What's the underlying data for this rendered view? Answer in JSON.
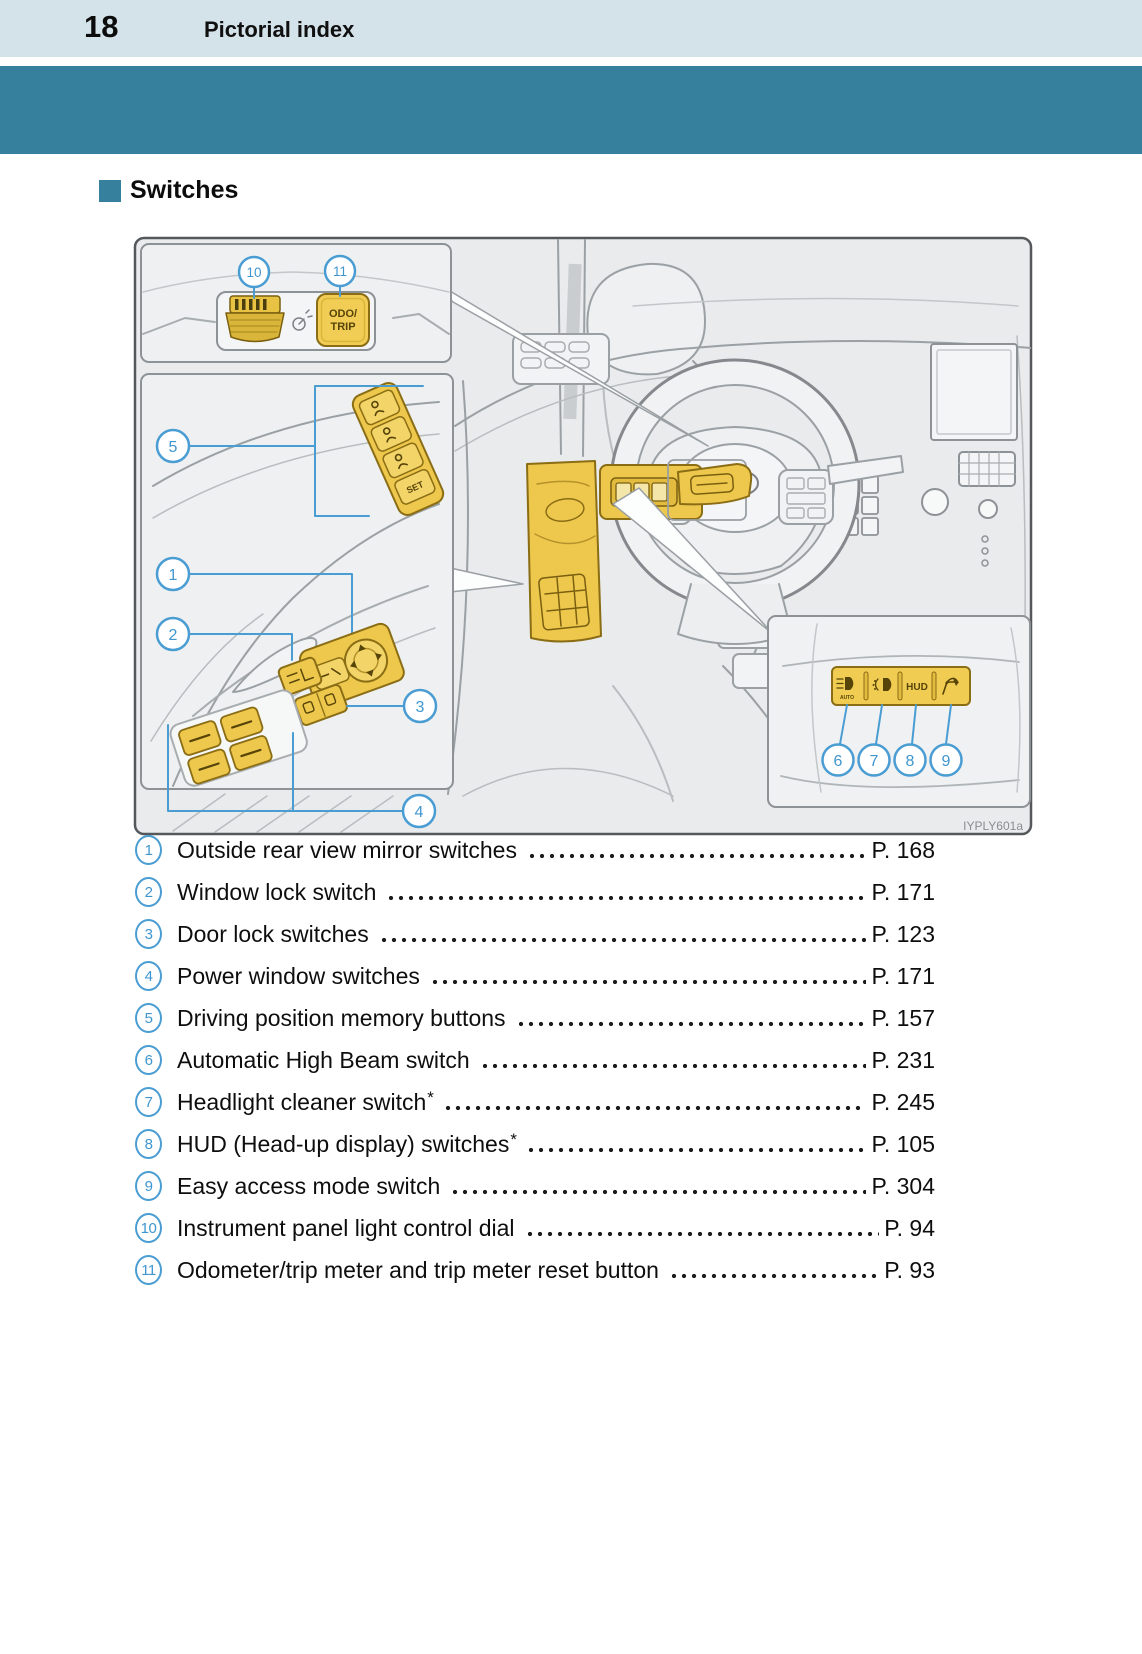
{
  "page": {
    "number": "18",
    "section": "Pictorial index"
  },
  "section": {
    "title": "Switches"
  },
  "colors": {
    "teal": "#36809e",
    "header_bg": "#d4e2e9",
    "callout_blue": "#4a9dd3",
    "highlight_yellow": "#eec84d"
  },
  "figure": {
    "code": "IYPLY601a",
    "callouts": [
      "1",
      "2",
      "3",
      "4",
      "5",
      "6",
      "7",
      "8",
      "9",
      "10",
      "11"
    ],
    "labels": {
      "odo_line1": "ODO/",
      "odo_line2": "TRIP",
      "set": "SET",
      "hud": "HUD",
      "auto": "AUTO"
    }
  },
  "index": {
    "items": [
      {
        "num": "1",
        "label": "Outside rear view mirror switches",
        "suffix": "",
        "page": "P. 168"
      },
      {
        "num": "2",
        "label": "Window lock switch",
        "suffix": "",
        "page": "P. 171"
      },
      {
        "num": "3",
        "label": "Door lock switches",
        "suffix": "",
        "page": "P. 123"
      },
      {
        "num": "4",
        "label": "Power window switches",
        "suffix": "",
        "page": "P. 171"
      },
      {
        "num": "5",
        "label": "Driving position memory buttons",
        "suffix": "",
        "page": "P. 157"
      },
      {
        "num": "6",
        "label": "Automatic High Beam switch",
        "suffix": "",
        "page": "P. 231"
      },
      {
        "num": "7",
        "label": "Headlight cleaner switch",
        "suffix": "*",
        "page": "P. 245"
      },
      {
        "num": "8",
        "label": "HUD (Head-up display) switches",
        "suffix": "*",
        "page": "P. 105"
      },
      {
        "num": "9",
        "label": "Easy access mode switch",
        "suffix": "",
        "page": "P. 304"
      },
      {
        "num": "10",
        "label": "Instrument panel light control dial",
        "suffix": "",
        "page": "P. 94"
      },
      {
        "num": "11",
        "label": "Odometer/trip meter and trip meter reset button",
        "suffix": "",
        "page": "P. 93"
      }
    ]
  }
}
